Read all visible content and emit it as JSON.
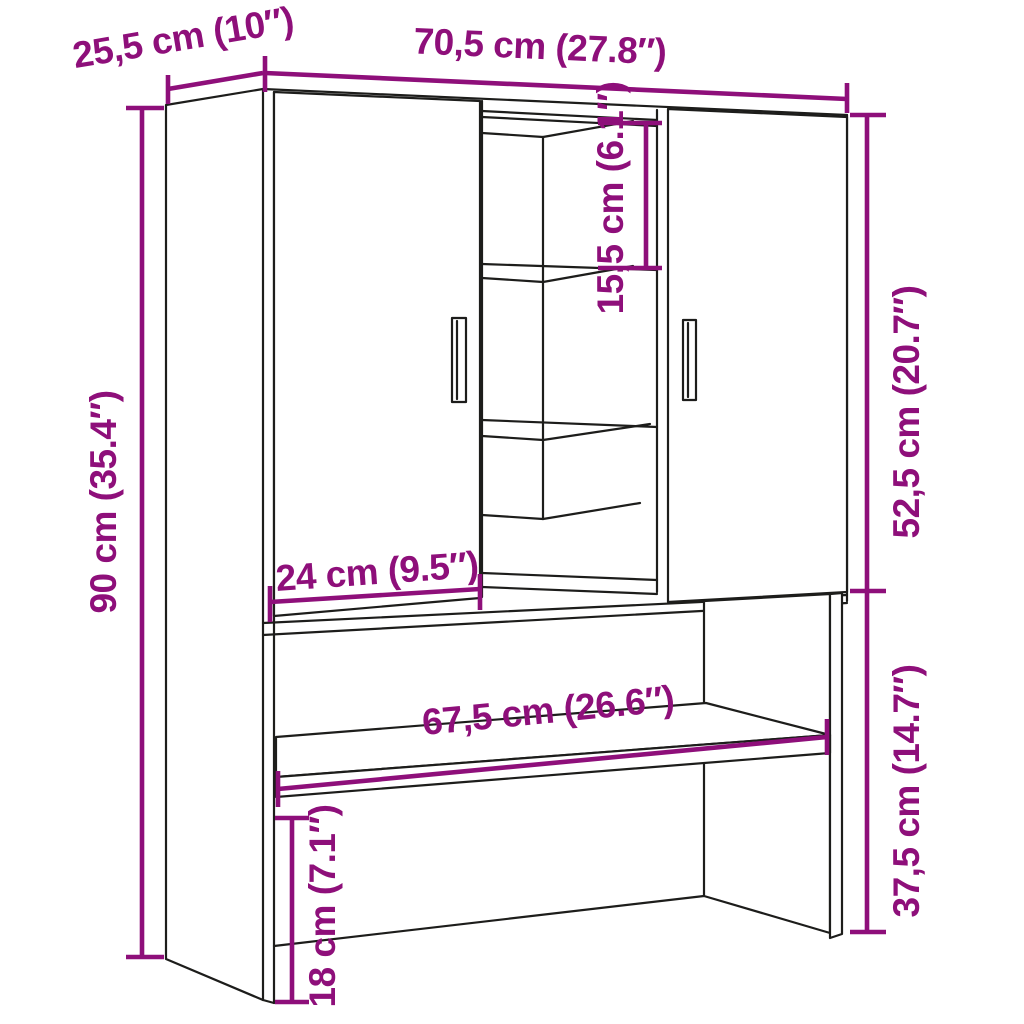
{
  "figure": {
    "type": "product-dimension-diagram",
    "background": "#ffffff"
  },
  "palette": {
    "dimension_color": "#8e0f7a",
    "outline_color": "#1d1d1b"
  },
  "dims": {
    "width_top": {
      "label": "70,5 cm (27.8″)"
    },
    "depth_top": {
      "label": "25,5 cm (10″)"
    },
    "height_left": {
      "label": "90 cm (35.4″)"
    },
    "inner_shelf": {
      "label": "15,5 cm (6.1″)"
    },
    "upper_right": {
      "label": "52,5 cm (20.7″)"
    },
    "door_width": {
      "label": "24 cm (9.5″)"
    },
    "shelf_width": {
      "label": "67,5 cm (26.6″)"
    },
    "lower_right": {
      "label": "37,5 cm (14.7″)"
    },
    "base_height": {
      "label": "18 cm (7.1″)"
    }
  }
}
